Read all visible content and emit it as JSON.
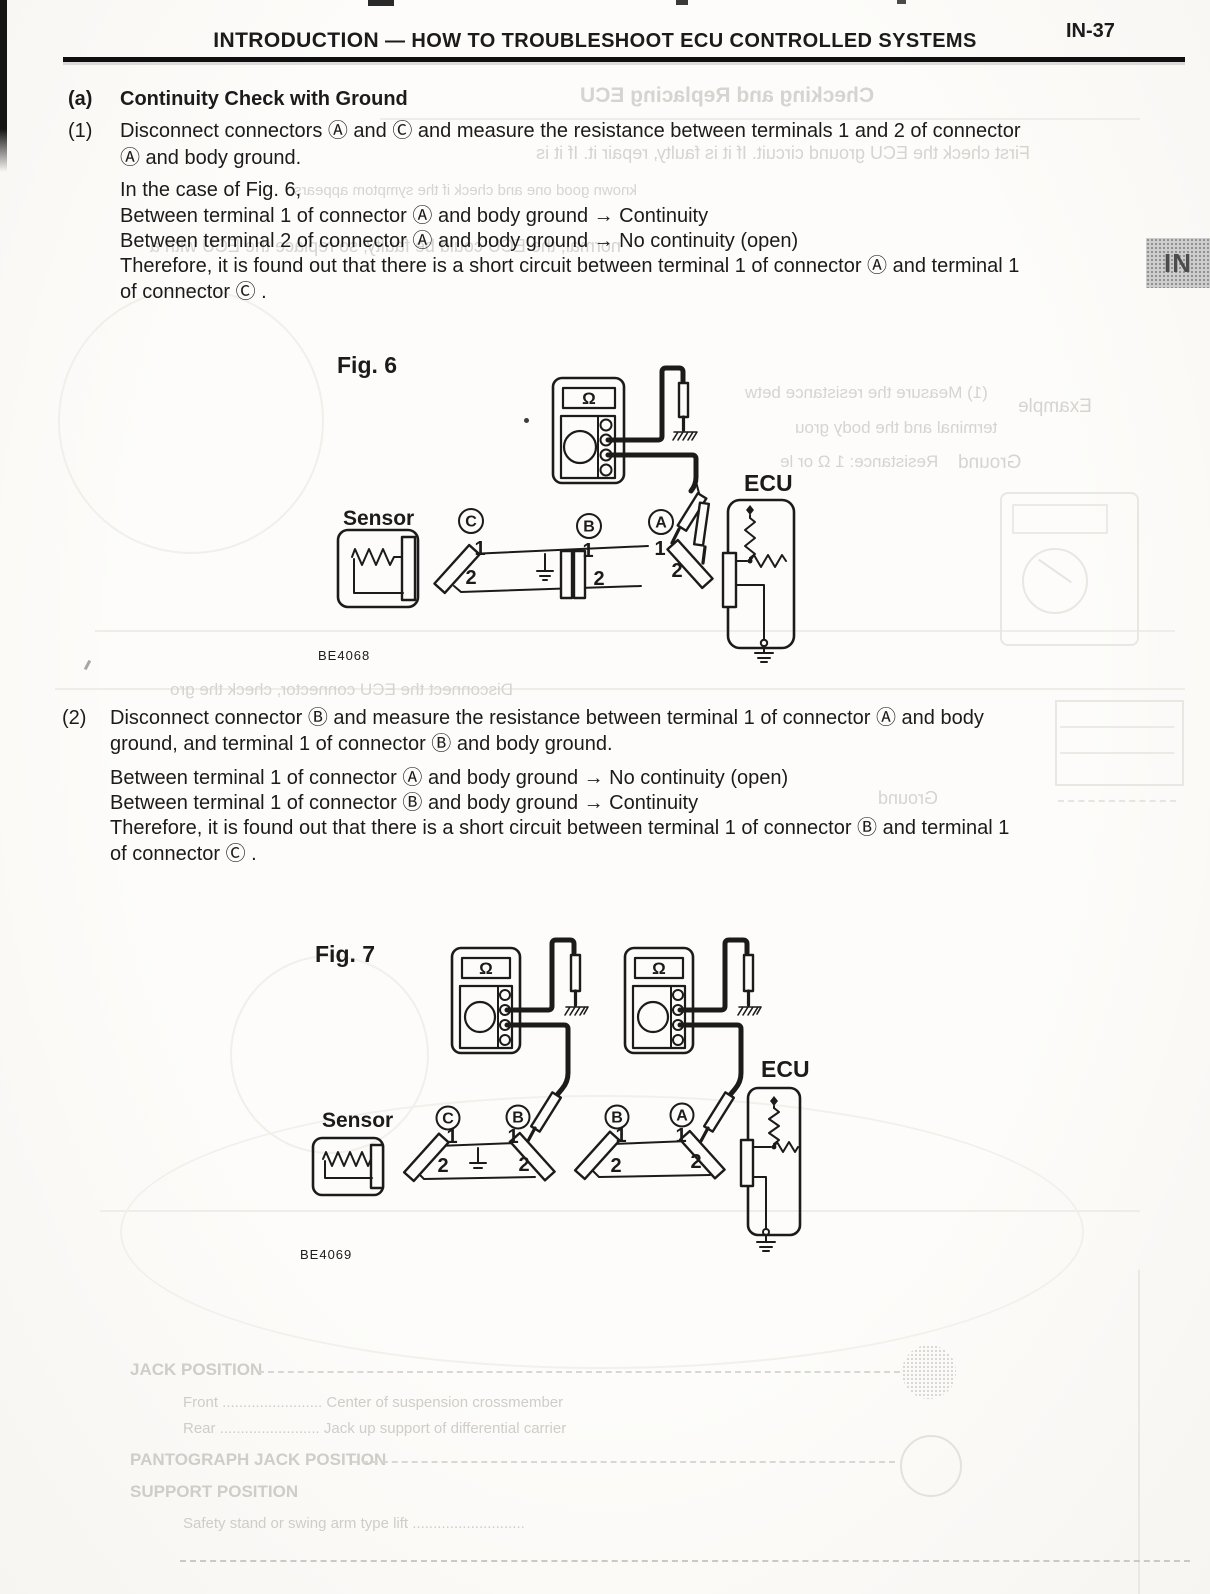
{
  "header": {
    "title_main": "INTRODUCTION",
    "title_sep": "—",
    "title_rest": "HOW TO TROUBLESHOOT ECU CONTROLLED SYSTEMS",
    "page_number": "IN-37"
  },
  "side_tab": {
    "label": "IN"
  },
  "section_a": {
    "label": "(a)",
    "title": "Continuity Check with Ground"
  },
  "step1": {
    "label": "(1)",
    "line1": "Disconnect connectors Ⓐ and Ⓒ and measure the resistance between terminals 1 and 2 of connector",
    "line2": "Ⓐ and body ground.",
    "case_line": "In the case of Fig. 6,",
    "result1": "Between terminal 1 of connector Ⓐ and body ground → Continuity",
    "result2": "Between terminal 2 of connector Ⓐ and body ground → No continuity (open)",
    "conclusion1": "Therefore, it is found out that there is a short circuit between terminal 1 of connector Ⓐ and terminal 1",
    "conclusion2": "of connector Ⓒ ."
  },
  "fig6": {
    "caption": "Fig. 6",
    "code": "BE4068",
    "sensor": "Sensor",
    "ecu": "ECU",
    "ohm": "Ω",
    "conn_c": "C",
    "conn_b": "B",
    "conn_a": "A",
    "t1": "1",
    "t2": "2"
  },
  "step2": {
    "label": "(2)",
    "line1": "Disconnect connector Ⓑ and measure the resistance between terminal 1 of connector Ⓐ and body",
    "line2": "ground, and terminal 1 of connector Ⓑ and body ground.",
    "result1": "Between terminal 1 of connector Ⓐ and body ground → No continuity (open)",
    "result2": "Between terminal 1 of connector Ⓑ and body ground → Continuity",
    "conclusion1": "Therefore, it is found out that there is a short circuit between terminal 1 of connector Ⓑ and terminal 1",
    "conclusion2": "of connector Ⓒ ."
  },
  "fig7": {
    "caption": "Fig. 7",
    "code": "BE4069",
    "sensor": "Sensor",
    "ecu": "ECU",
    "ohm": "Ω",
    "conn_c": "C",
    "conn_b_left": "B",
    "conn_b_right": "B",
    "conn_a": "A",
    "t1": "1",
    "t2": "2"
  },
  "ghost": {
    "heading": "Checking and Replacing ECU",
    "line1": "First check the ECU ground circuit. If it is faulty, repair it. If it is",
    "line2": "known good one and check if the symptom appears.",
    "line3": "normal, the ECU could be faulty, so replace the ECU with a",
    "fig6_m1": "(1)  Measure the resistance betw",
    "fig6_m2": "terminal and the body grou",
    "fig6_m3": "Resistance:    1 Ω or le",
    "example": "Example",
    "ground1": "Ground",
    "step2_m": "Disconnect the ECU connector, check the gro",
    "ground2": "Ground",
    "jack_h1": "JACK POSITION",
    "jack_row1": "Front ........................   Center of suspension crossmember",
    "jack_row2": "Rear ........................   Jack up support of differential carrier",
    "jack_h2": "PANTOGRAPH JACK POSITION",
    "jack_h3": "SUPPORT POSITION",
    "jack_row3": "Safety stand or swing arm type lift ..........................."
  }
}
